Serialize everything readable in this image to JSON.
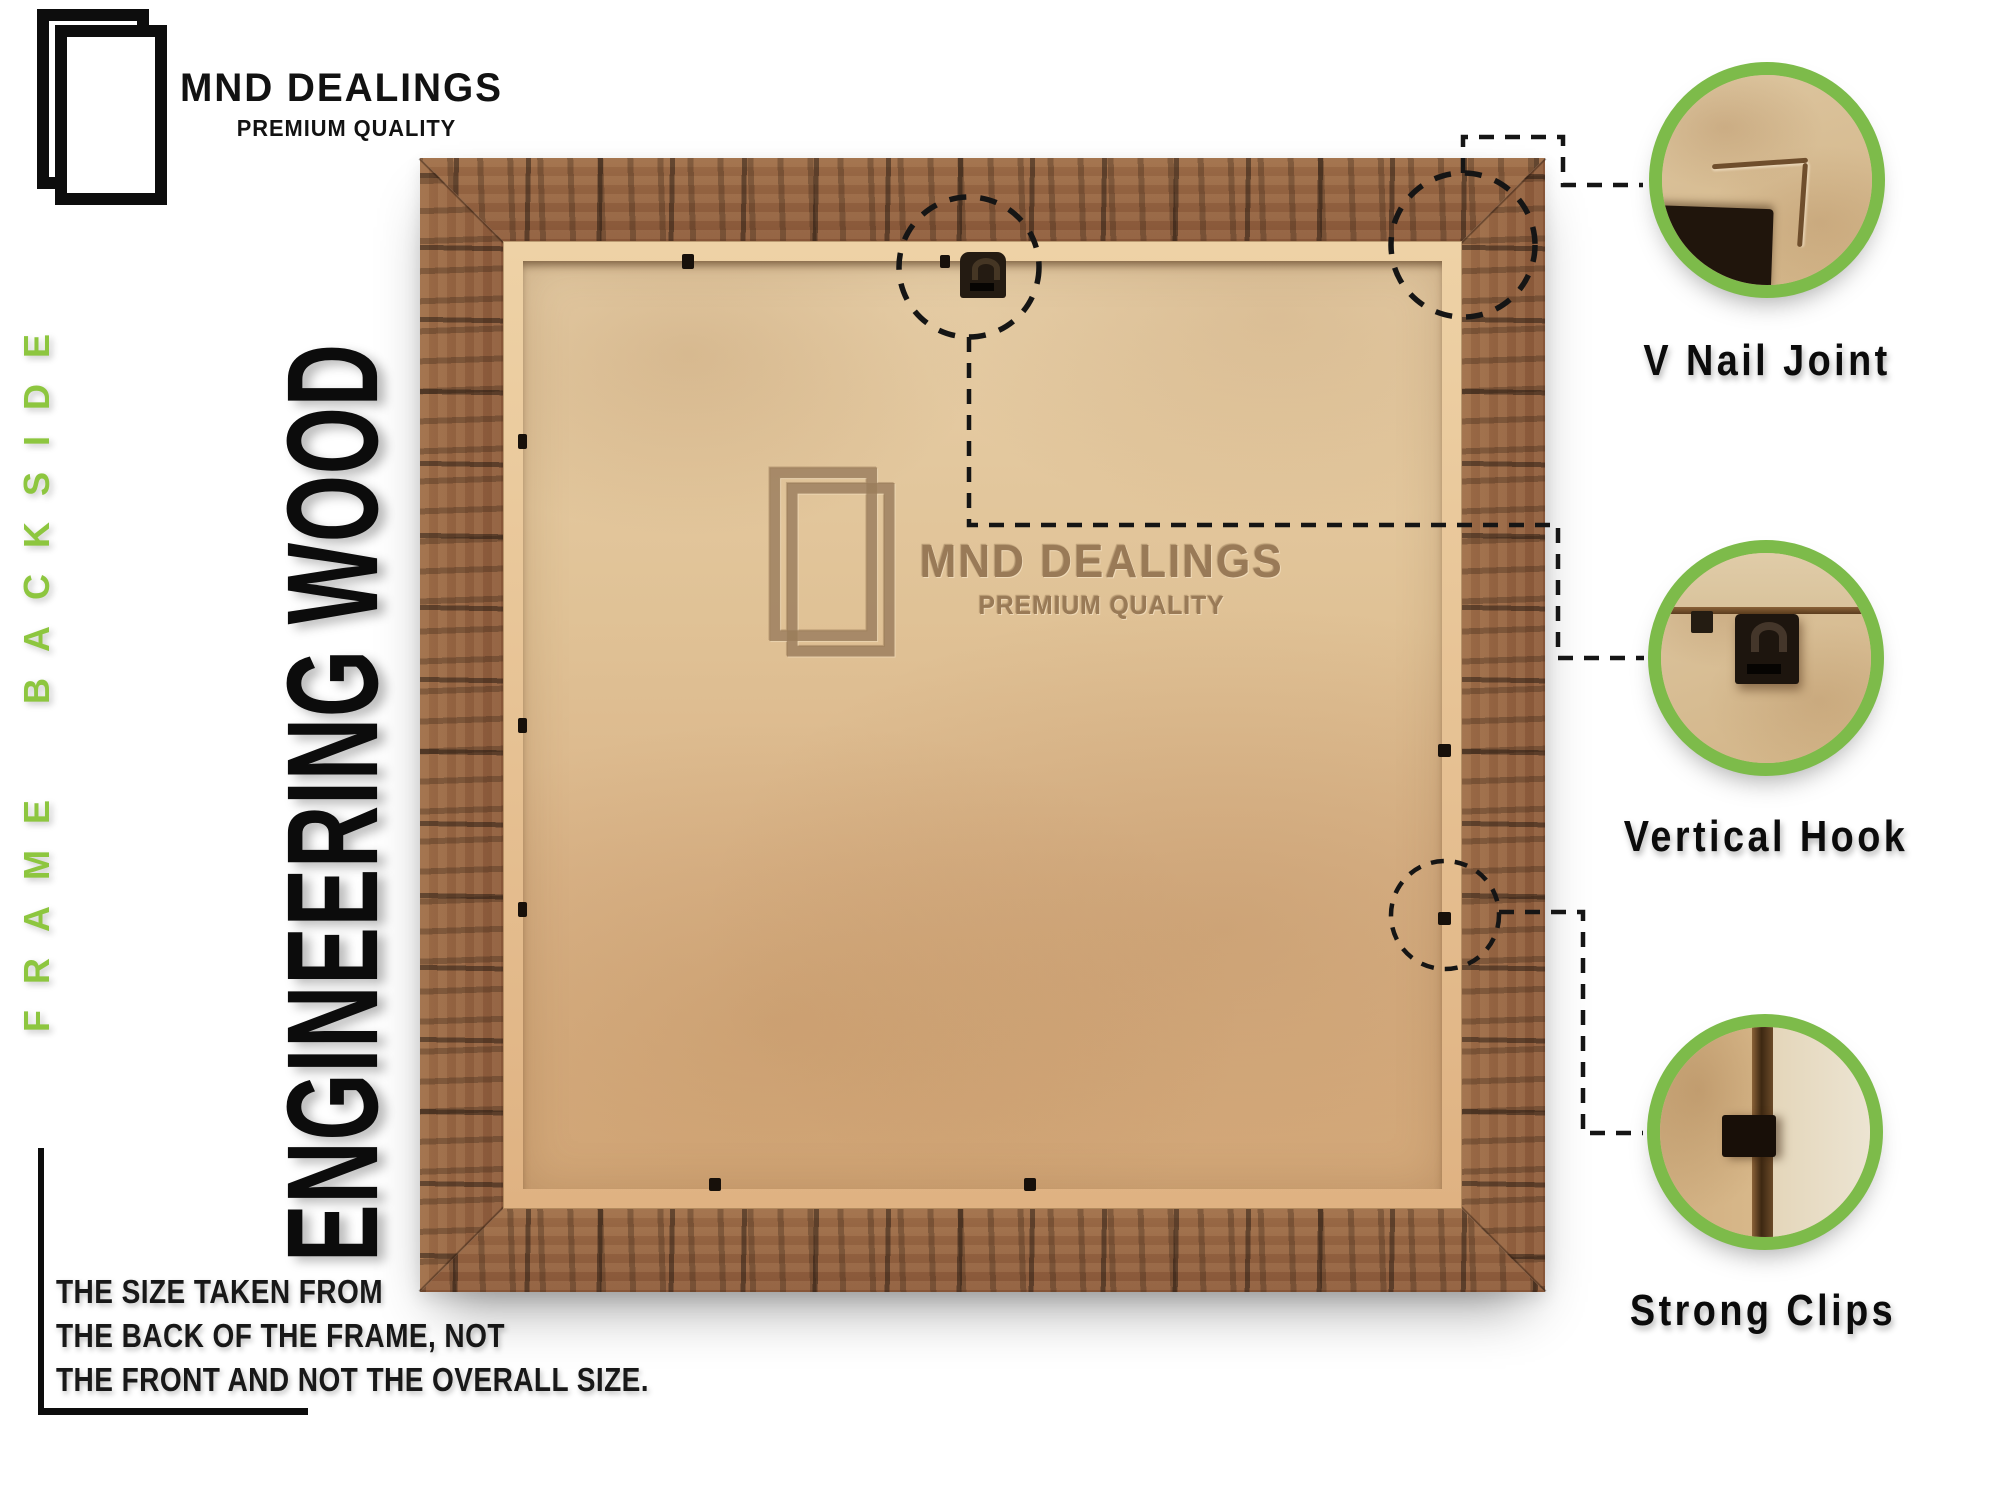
{
  "brand": {
    "name": "MND DEALINGS",
    "tagline": "PREMIUM QUALITY"
  },
  "side_label": "FRAME BACKSIDE",
  "material_label": "ENGINEERING WOOD",
  "note_lines": [
    "THE SIZE TAKEN FROM",
    "THE BACK OF THE FRAME, NOT",
    "THE FRONT AND NOT THE OVERALL SIZE."
  ],
  "watermark": {
    "name": "MND DEALINGS",
    "tagline": "PREMIUM QUALITY"
  },
  "callouts": [
    {
      "label": "V Nail Joint"
    },
    {
      "label": "Vertical Hook"
    },
    {
      "label": "Strong Clips"
    }
  ],
  "colors": {
    "accent_green": "#7dbb4a",
    "text_green": "#8dc63f",
    "ink": "#111111",
    "wood_brown": "#8e6040",
    "mdf_tan": "#dcbd92"
  }
}
